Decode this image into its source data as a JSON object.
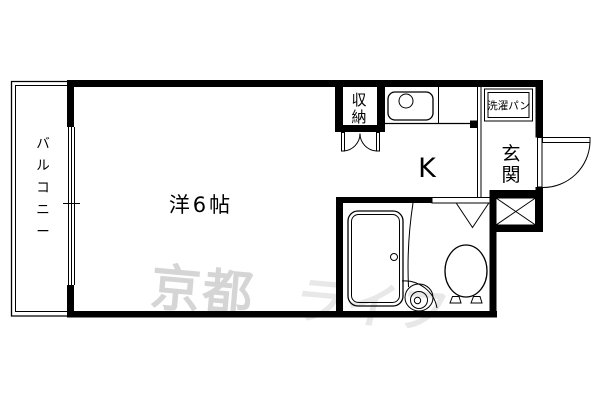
{
  "plan": {
    "rooms": {
      "balcony": {
        "label": "バルコニー"
      },
      "main_room": {
        "label": "洋6帖"
      },
      "kitchen": {
        "label": "K"
      },
      "closet": {
        "label": "収納"
      },
      "entrance": {
        "label": "玄関"
      },
      "laundry_pan": {
        "label": "洗濯パン"
      }
    },
    "fixtures": [
      "kitchen-sink",
      "bathtub",
      "wash-basin",
      "toilet",
      "entrance-door",
      "closet-doors",
      "bathroom-door",
      "window",
      "shoe-box"
    ],
    "watermark": {
      "part1": "京都",
      "part2": "ライフ"
    },
    "colors": {
      "line": "#000000",
      "background": "#ffffff",
      "watermark_dark": "#d5d5d5",
      "watermark_light": "#e8e8e8"
    }
  }
}
